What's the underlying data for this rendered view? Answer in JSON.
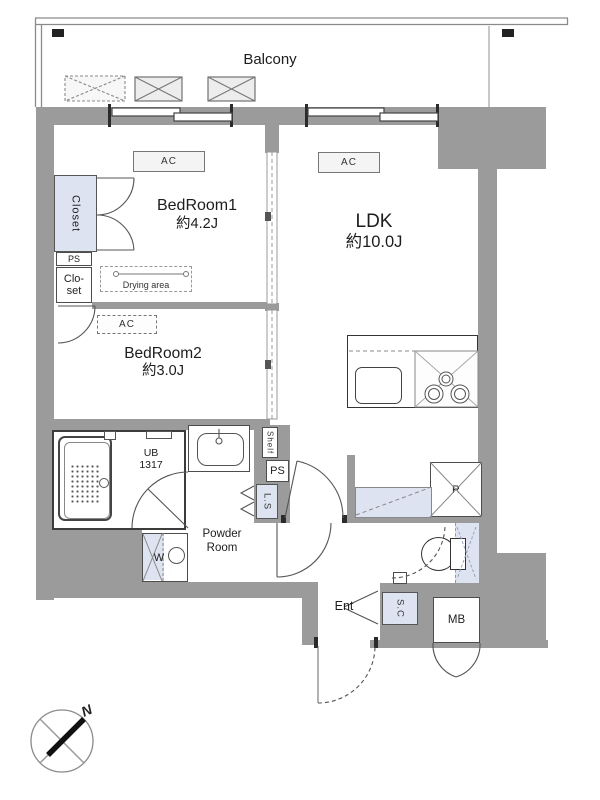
{
  "balcony": {
    "label": "Balcony"
  },
  "rooms": {
    "bedroom1": {
      "name": "BedRoom1",
      "size": "約4.2J"
    },
    "bedroom2": {
      "name": "BedRoom2",
      "size": "約3.0J"
    },
    "ldk": {
      "name": "LDK",
      "size": "約10.0J"
    },
    "bath": {
      "name": "UB",
      "size": "1317"
    },
    "powder_room": {
      "line1": "Powder",
      "line2": "Room"
    },
    "entrance": {
      "label": "Ent"
    }
  },
  "fixtures": {
    "ac": "AC",
    "closet": "Closet",
    "ps": "PS",
    "clo_line1": "Clo-",
    "clo_line2": "set",
    "drying_area": "Drying area",
    "shelf": "Shelf",
    "ls": "L.S",
    "washer": "W",
    "refrigerator": "R",
    "shoe_closet": "S.C",
    "meter_box": "MB"
  },
  "compass": {
    "north": "N"
  },
  "colors": {
    "wall": "#9b9b9b",
    "fixture_fill": "#dde3f0",
    "line": "#4d4d4d"
  }
}
